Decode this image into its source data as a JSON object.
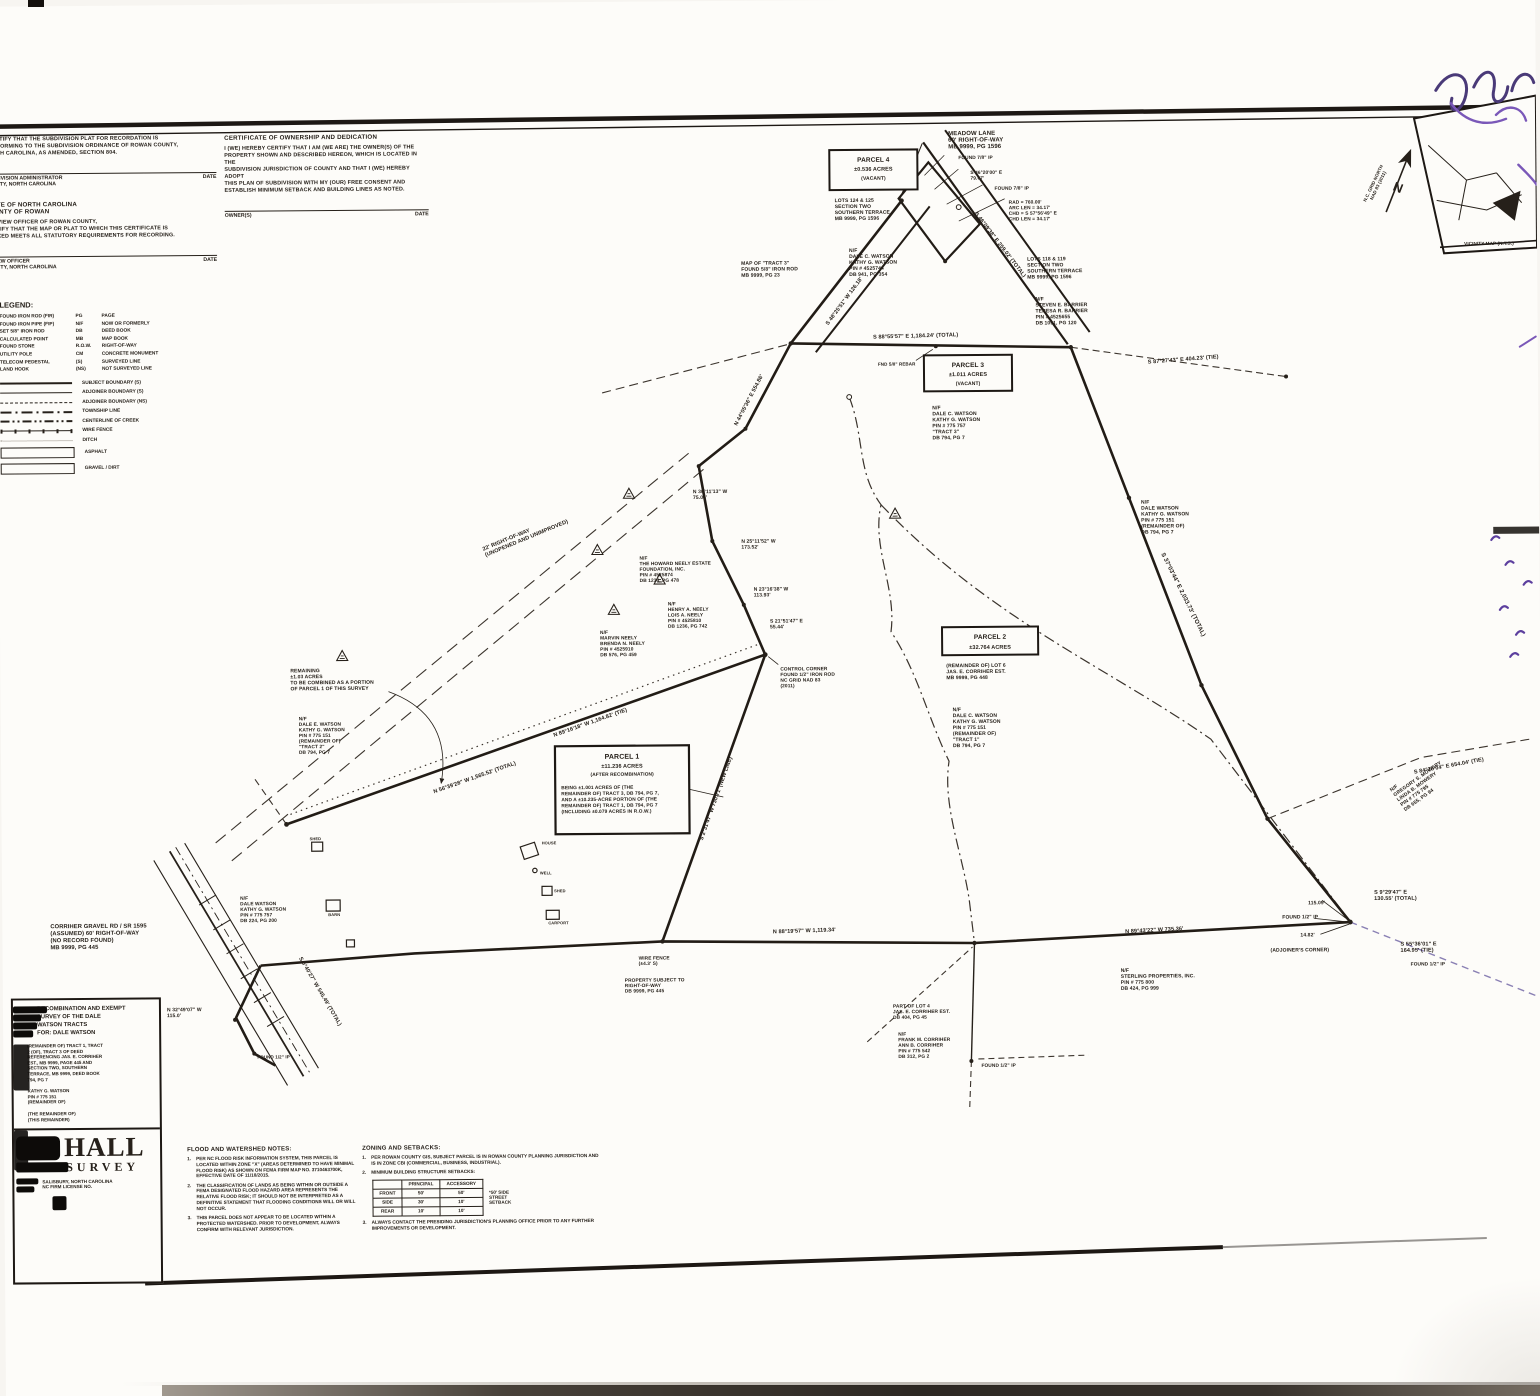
{
  "palette": {
    "ink": "#26201a",
    "faint": "#6f675f",
    "purple": "#5c3f9e",
    "purple_light": "#8a80b4",
    "paper": "#fdfcf9"
  },
  "certificates": {
    "approval": {
      "body": "I CERTIFY THAT THE SUBDIVISION PLAT FOR RECORDATION IS\nCONFORMING TO THE SUBDIVISION ORDINANCE OF ROWAN COUNTY,\nNORTH CAROLINA, AS AMENDED, SECTION 804.",
      "sig_caption": "SUBDIVISION ADMINISTRATOR\nCOUNTY, NORTH CAROLINA",
      "date_label": "DATE"
    },
    "state_heading": "STATE OF NORTH CAROLINA\nCOUNTY OF ROWAN",
    "review": {
      "body": "I, REVIEW OFFICER OF ROWAN COUNTY,\nCERTIFY THAT THE MAP OR PLAT TO WHICH THIS CERTIFICATE IS\nAFFIXED MEETS ALL STATUTORY REQUIREMENTS FOR RECORDING.",
      "sig_caption": "REVIEW OFFICER\nCOUNTY, NORTH CAROLINA",
      "date_label": "DATE"
    },
    "ownership": {
      "title": "CERTIFICATE OF OWNERSHIP AND DEDICATION",
      "body": "I (WE) HEREBY CERTIFY THAT I AM (WE ARE) THE OWNER(S) OF THE\nPROPERTY SHOWN AND DESCRIBED HEREON, WHICH IS LOCATED IN THE\nSUBDIVISION JURISDICTION OF COUNTY AND THAT I (WE) HEREBY ADOPT\nTHIS PLAN OF SUBDIVISION WITH MY (OUR) FREE CONSENT AND\nESTABLISH MINIMUM SETBACK AND BUILDING LINES AS NOTED.",
      "sig_caption": "OWNER(S)",
      "date_label": "DATE"
    }
  },
  "legend": {
    "title": "LEGEND:",
    "defs": [
      {
        "left": "FOUND IRON ROD (FIR)",
        "abbr": "PG",
        "right": "PAGE"
      },
      {
        "left": "FOUND IRON PIPE (FIP)",
        "abbr": "N/F",
        "right": "NOW OR FORMERLY"
      },
      {
        "left": "SET 5/8\" IRON ROD",
        "abbr": "DB",
        "right": "DEED BOOK"
      },
      {
        "left": "CALCULATED POINT",
        "abbr": "MB",
        "right": "MAP BOOK"
      },
      {
        "left": "FOUND STONE",
        "abbr": "R.O.W.",
        "right": "RIGHT-OF-WAY"
      },
      {
        "left": "UTILITY POLE",
        "abbr": "CM",
        "right": "CONCRETE MONUMENT"
      },
      {
        "left": "TELECOM PEDESTAL",
        "abbr": "(S)",
        "right": "SURVEYED LINE"
      },
      {
        "left": "LAND HOOK",
        "abbr": "(NS)",
        "right": "NOT SURVEYED LINE"
      }
    ],
    "lines": [
      {
        "label": "SUBJECT BOUNDARY (S)"
      },
      {
        "label": "ADJOINER BOUNDARY (S)"
      },
      {
        "label": "ADJOINER BOUNDARY (NS)"
      },
      {
        "label": "TOWNSHIP LINE"
      },
      {
        "label": "CENTERLINE OF CREEK"
      },
      {
        "label": "WIRE FENCE"
      },
      {
        "label": "DITCH"
      }
    ],
    "areas": [
      "ASPHALT",
      "GRAVEL / DIRT"
    ]
  },
  "north": {
    "letter": "N",
    "caption": "N.C. GRID NORTH\nNAD 83 (2011)"
  },
  "vicinity": {
    "caption": "VICINITY MAP (N.T.S.)"
  },
  "parcels": {
    "p1": {
      "name": "PARCEL 1",
      "acres": "±11.236 ACRES",
      "note": "(AFTER RECOMBINATION)",
      "desc": "BEING ±1.001 ACRES OF (THE\nREMAINDER OF) TRACT 3, DB 794, PG 7,\nAND A ±10.235-ACRE PORTION OF (THE\nREMAINDER OF) TRACT 1, DB 794, PG 7\n(INCLUDING ±0.079 ACRES IN R.O.W.)"
    },
    "p2": {
      "name": "PARCEL 2",
      "acres": "±32.764 ACRES",
      "sub1": "(REMAINDER OF) LOT 6\nJAS. E. CORRIHER EST.\nMB 9999, PG 448",
      "sub2": "N/F\nDALE C. WATSON\nKATHY G. WATSON\nPIN # 775 151\n(REMAINDER OF)\n\"TRACT 1\"\nDB 794, PG 7"
    },
    "p3": {
      "name": "PARCEL 3",
      "acres": "±1.011 ACRES",
      "note": "(VACANT)",
      "sub": "N/F\nDALE C. WATSON\nKATHY G. WATSON\nPIN # 775 757\n\"TRACT 3\"\nDB 794, PG 7"
    },
    "p4": {
      "name": "PARCEL 4",
      "acres": "±0.536 ACRES",
      "note": "(VACANT)",
      "sub1": "LOTS 124 & 125\nSECTION TWO\nSOUTHERN TERRACE\nMB 9999, PG 1596",
      "sub2": "N/F\nDALE C. WATSON\nKATHY G. WATSON\nPIN # 4525744\nDB 941, PG 354"
    }
  },
  "labels": {
    "meadow_lane": "MEADOW LANE\n60' RIGHT-OF-WAY\nMB 9999, PG 1596",
    "found78": "FOUND 7/8\" IP",
    "meadow_tie": "S 46°20'00\" E\n79.67'",
    "found78b": "FOUND 7/8\" IP",
    "curve_data": "RAD = 760.00'\nARC LEN = 34.17'\nCHD = S 57°56'49\" E\nCHD LEN = 34.17'",
    "b_s48": "S 48°25'51\" W 126.18'",
    "b_roadB": "S 46°09'38\" E 259.02' (TOTAL)",
    "map_tract": "MAP OF \"TRACT 3\"\nFOUND 5/8\" IRON ROD\nMB 9999, PG 23",
    "lots_terr": "LOTS 118 & 119\nSECTION TWO\nSOUTHERN TERRACE\nMB 9999, PG 1596",
    "barrier": "N/F\nSTEVEN E. BARRIER\nTERESA R. BARRIER\nPIN # 4525655\nDB 1091, PG 120",
    "b_s2": "S 88°55'57\" E 1,184.24' (TOTAL)",
    "fnd_rebar": "FND 5/8\" REBAR",
    "b_tie_e": "S 87°27'43\" E 404.23' (TIE)",
    "b_right": "S 37°03'44\" E 2,033.73' (TOTAL)",
    "watson_mid": "N/F\nDALE WATSON\nKATHY G. WATSON\nPIN # 775 151\n(REMAINDER OF)\nDB 794, PG 7",
    "mowery": "N/F\nGREGORY S. MOWERY\nLINDA B. MOWERY\nPIN # 775 795\nDB 655, PG 94",
    "b_ne_tie": "S 84°26'04\" E 654.04' (TIE)",
    "control_corner": "CONTROL CORNER\nFOUND 1/2\" IRON ROD\nNC GRID NAD 83\n(2011)",
    "b_p1e": "S 2°31'47\" W 730.71' (NEW LINE)",
    "b_nw1": "N 89°16'18\" W 1,164.82' (TIE)",
    "b_nw2": "N 56°39'28\" W 1,565.52' (TOTAL)",
    "row22": "22' RIGHT-OF-WAY\n(UNOPENED AND UNIMPROVED)",
    "neely1": "N/F\nTHE HOWARD NEELY ESTATE\nFOUNDATION, INC.\nPIN # 4525874\nDB 1234, PG 478",
    "neely2": "N/F\nHENRY A. NEELY\nLOIS A. NEELY\nPIN # 4525810\nDB 1236, PG 742",
    "neely3": "N/F\nMARVIN NEELY\nBRENDA N. NEELY\nPIN # 4525910\nDB 576, PG 459",
    "b_w1": "N 30°11'13\" W\n75.06'",
    "b_w2": "N 25°11'52\" W\n173.52'",
    "b_w3": "N 23°16'38\" W\n113.93'",
    "b_w4": "S 21°51'47\" E\n55.44'",
    "remain103": "REMAINING\n±1.03 ACRES\nTO BE COMBINED AS A PORTION\nOF PARCEL 1 OF THIS SURVEY",
    "watson_rem2": "N/F\nDALE E. WATSON\nKATHY G. WATSON\nPIN # 775 151\n(REMAINDER OF)\n\"TRACT 2\"\nDB 794, PG 7",
    "corriher_rd": "CORRIHER GRAVEL RD / SR 1595\n(ASSUMED) 60' RIGHT-OF-WAY\n(NO RECORD FOUND)\nMB 9999, PG 445",
    "watson_w": "N/F\nDALE WATSON\nKATHY G. WATSON\nPIN # 775 757\nDB 224, PG 200",
    "b_road_sw": "S 6°40'27\" W 545.49' (TOTAL)",
    "b_road_sw2": "N 32°49'07\" W\n115.0'",
    "fip_hook": "FOUND 1/2\" IP",
    "b_bottom_l": "N 88°19'57\" W 1,119.34'",
    "b_bottom_r": "N 89°43'22\" W 735.36'",
    "fence": "WIRE FENCE\n(±4.3' S)",
    "prop_subj": "PROPERTY SUBJECT TO\nRIGHT-OF-WAY\nDB 9999, PG 445",
    "sterling": "N/F\nSTERLING PROPERTIES, INC.\nPIN # 775 800\nDB 424, PG 999",
    "lot4": "PART OF LOT 4\nJAS. E. CORRIHER EST.\nDB 404, PG 45",
    "frank": "N/F\nFRANK M. CORRIHER\nANN B. CORRIHER\nPIN # 775 542\nDB 312, PG 2",
    "fip_bottom": "FOUND 1/2\" IP",
    "se_115": "115.09'",
    "se_fip": "FOUND 1/2\" IP",
    "se_1482": "14.82'",
    "se_adj": "(ADJOINER'S CORNER)",
    "b_se1": "S 9°29'47\" E\n130.55' (TOTAL)",
    "b_se2": "S 55°36'01\" E\n164.95' (TIE)",
    "se_fip2": "FOUND 1/2\" IP",
    "b_upper_ne": "N 44°05'36\" E 554.86'",
    "house": "HOUSE",
    "shed1": "SHED",
    "barn": "BARN",
    "shed2": "SHED",
    "carport": "CARPORT",
    "well": "WELL"
  },
  "notes": {
    "flood_title": "FLOOD AND WATERSHED NOTES:",
    "flood": [
      {
        "n": "1.",
        "text": "PER NC FLOOD RISK INFORMATION SYSTEM, THIS PARCEL IS LOCATED WITHIN ZONE \"X\" (AREAS DETERMINED TO HAVE MINIMAL FLOOD RISK) AS SHOWN ON FEMA FIRM MAP NO. 3710463700K, EFFECTIVE DATE OF 11/18/2015."
      },
      {
        "n": "2.",
        "text": "THE CLASSIFICATION OF LANDS AS BEING WITHIN OR OUTSIDE A FEMA DESIGNATED FLOOD HAZARD AREA REPRESENTS THE RELATIVE FLOOD RISK; IT SHOULD NOT BE INTERPRETED AS A DEFINITIVE STATEMENT THAT FLOODING CONDITIONS WILL OR WILL NOT OCCUR."
      },
      {
        "n": "3.",
        "text": "THIS PARCEL DOES NOT APPEAR TO BE LOCATED WITHIN A PROTECTED WATERSHED. PRIOR TO DEVELOPMENT, ALWAYS CONFIRM WITH RELEVANT JURISDICTION."
      }
    ],
    "zoning_title": "ZONING AND SETBACKS:",
    "zoning": [
      {
        "n": "1.",
        "text": "PER ROWAN COUNTY GIS, SUBJECT PARCEL IS IN ROWAN COUNTY PLANNING JURISDICTION AND IS IN ZONE CBI (COMMERCIAL, BUSINESS, INDUSTRIAL)."
      },
      {
        "n": "2.",
        "text": "MINIMUM BUILDING STRUCTURE SETBACKS:"
      },
      {
        "n": "3.",
        "text": "ALWAYS CONTACT THE PRESIDING JURISDICTION'S PLANNING OFFICE PRIOR TO ANY FURTHER IMPROVEMENTS OR DEVELOPMENT."
      }
    ],
    "setbacks": {
      "headers": [
        "",
        "PRINCIPAL",
        "ACCESSORY"
      ],
      "rows": [
        {
          "label": "FRONT",
          "principal": "50'",
          "accessory": "50'"
        },
        {
          "label": "SIDE",
          "principal": "30'",
          "accessory": "10'"
        },
        {
          "label": "REAR",
          "principal": "10'",
          "accessory": "10'"
        }
      ],
      "note": "*50' SIDE\nSTREET\nSETBACK"
    }
  },
  "title_block": {
    "line1": "RECOMBINATION AND EXEMPT",
    "line2": "SURVEY OF THE DALE",
    "line3": "WATSON TRACTS",
    "line4": "FOR: DALE WATSON",
    "para": "(REMAINDER OF) TRACT 1, TRACT\n2 (OF), TRACT 3 OF DEED\nREFERENCING JAS. E. CORRIHER\nEST., MB 9999, PAGE 445 AND\nSECTION TWO, SOUTHERN\nTERRACE, MB 9999, DEED BOOK\n794, PG 7",
    "para2": "KATHY G. WATSON\nPIN # 775 151\n(REMAINDER OF)",
    "para3": "(THE REMAINDER OF)\n(THIS REMAINDER)",
    "logo": "HALL",
    "logo_sub": "SURVEY",
    "addr1": "SALISBURY, NORTH CAROLINA",
    "addr2": "NC FIRM LICENSE NO."
  }
}
